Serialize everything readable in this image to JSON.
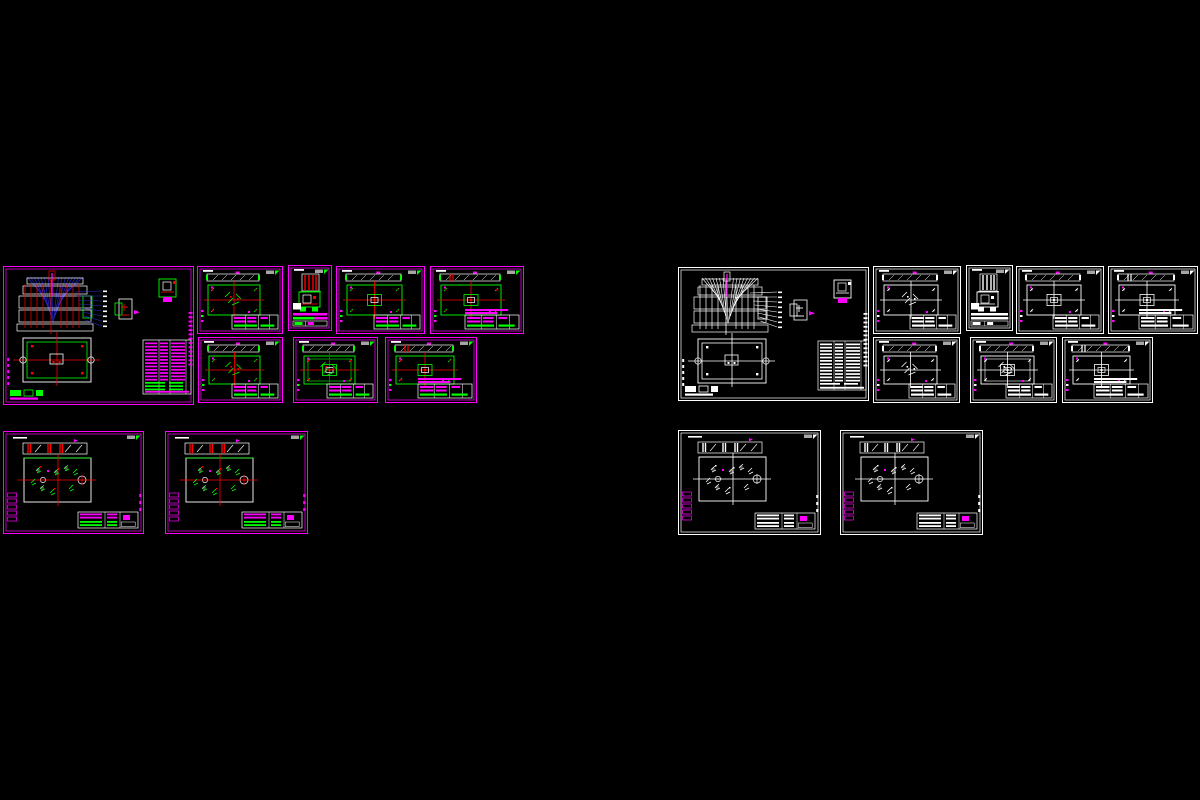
{
  "app": {
    "name": "cad-model-space",
    "background": "#000000",
    "description": "CAD model space with mold design drawing sheets"
  },
  "palette": {
    "black": "#000000",
    "white": "#FFFFFF",
    "magenta": "#FF00FF",
    "green": "#00FF00",
    "red": "#FF0000",
    "blue": "#2B2BDD",
    "gray": "#A6A6A6"
  },
  "schemes": {
    "colored": {
      "frame": "magenta",
      "geo": "green",
      "center": "red",
      "leader": "blue",
      "body": "white",
      "table": "magenta",
      "accent": "magenta",
      "label": "gray"
    },
    "mono": {
      "frame": "white",
      "geo": "white",
      "center": "white",
      "leader": "white",
      "body": "white",
      "table": "white",
      "accent": "magenta",
      "label": "gray"
    }
  },
  "groups": [
    {
      "id": "left-colored",
      "label": "colored drawing set",
      "scheme": "colored",
      "sheet_count": 10
    },
    {
      "id": "right-mono",
      "label": "monochrome drawing set",
      "scheme": "mono",
      "sheet_count": 10
    }
  ],
  "sheets": [
    {
      "id": "left-assembly",
      "group": "left-colored",
      "kind": "assembly",
      "variant": 0,
      "x": 3,
      "y": 266,
      "w": 191,
      "h": 139
    },
    {
      "id": "left-part-1",
      "group": "left-colored",
      "kind": "part",
      "variant": 1,
      "x": 197,
      "y": 266,
      "w": 86,
      "h": 68
    },
    {
      "id": "left-part-narrow",
      "group": "left-colored",
      "kind": "narrow",
      "variant": 0,
      "x": 288,
      "y": 265,
      "w": 44,
      "h": 66
    },
    {
      "id": "left-part-2",
      "group": "left-colored",
      "kind": "part",
      "variant": 2,
      "x": 336,
      "y": 266,
      "w": 89,
      "h": 68
    },
    {
      "id": "left-part-3",
      "group": "left-colored",
      "kind": "part",
      "variant": 3,
      "x": 430,
      "y": 266,
      "w": 94,
      "h": 68
    },
    {
      "id": "left-part-4",
      "group": "left-colored",
      "kind": "part",
      "variant": 4,
      "x": 198,
      "y": 337,
      "w": 85,
      "h": 66
    },
    {
      "id": "left-part-5",
      "group": "left-colored",
      "kind": "part",
      "variant": 5,
      "x": 293,
      "y": 337,
      "w": 85,
      "h": 66
    },
    {
      "id": "left-part-6",
      "group": "left-colored",
      "kind": "part",
      "variant": 6,
      "x": 385,
      "y": 337,
      "w": 92,
      "h": 66
    },
    {
      "id": "left-plate-1",
      "group": "left-colored",
      "kind": "plate",
      "variant": 0,
      "x": 3,
      "y": 431,
      "w": 141,
      "h": 103
    },
    {
      "id": "left-plate-2",
      "group": "left-colored",
      "kind": "plate",
      "variant": 1,
      "x": 165,
      "y": 431,
      "w": 143,
      "h": 103
    },
    {
      "id": "right-assembly",
      "group": "right-mono",
      "kind": "assembly",
      "variant": 0,
      "x": 678,
      "y": 267,
      "w": 191,
      "h": 134
    },
    {
      "id": "right-part-1",
      "group": "right-mono",
      "kind": "part",
      "variant": 1,
      "x": 873,
      "y": 266,
      "w": 88,
      "h": 68
    },
    {
      "id": "right-part-narrow",
      "group": "right-mono",
      "kind": "narrow",
      "variant": 0,
      "x": 966,
      "y": 265,
      "w": 47,
      "h": 66
    },
    {
      "id": "right-part-2",
      "group": "right-mono",
      "kind": "part",
      "variant": 2,
      "x": 1016,
      "y": 266,
      "w": 88,
      "h": 68
    },
    {
      "id": "right-part-3",
      "group": "right-mono",
      "kind": "part",
      "variant": 3,
      "x": 1108,
      "y": 266,
      "w": 90,
      "h": 68
    },
    {
      "id": "right-part-4",
      "group": "right-mono",
      "kind": "part",
      "variant": 4,
      "x": 873,
      "y": 337,
      "w": 87,
      "h": 66
    },
    {
      "id": "right-part-5",
      "group": "right-mono",
      "kind": "part",
      "variant": 5,
      "x": 970,
      "y": 337,
      "w": 87,
      "h": 66
    },
    {
      "id": "right-part-6",
      "group": "right-mono",
      "kind": "part",
      "variant": 6,
      "x": 1062,
      "y": 337,
      "w": 91,
      "h": 66
    },
    {
      "id": "right-plate-1",
      "group": "right-mono",
      "kind": "plate",
      "variant": 0,
      "x": 678,
      "y": 430,
      "w": 143,
      "h": 105
    },
    {
      "id": "right-plate-2",
      "group": "right-mono",
      "kind": "plate",
      "variant": 1,
      "x": 840,
      "y": 430,
      "w": 143,
      "h": 105
    }
  ]
}
